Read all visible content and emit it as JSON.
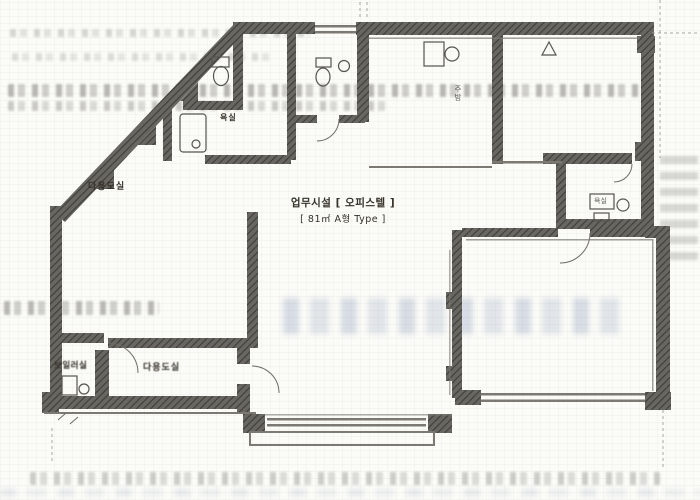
{
  "document_type": "scanned-floor-plan",
  "plan": {
    "title": "업무시설 [ 오피스텔 ]",
    "subtitle": "[ 81㎡ A형 Type ]",
    "rooms": {
      "utility_upper": "다용도실",
      "bath_upper": "욕실",
      "kitchen": "주방",
      "boiler_room": "보일러실",
      "utility_lower": "다용도실",
      "bath_right": "욕실"
    }
  },
  "colors": {
    "paper": "#fbfbf7",
    "wall_base": "#686661",
    "wall_hatch": "#3e3c37",
    "thin_line": "#7b7971",
    "label_ink": "#343129",
    "bleed_gray": "#5c5a54",
    "bleed_blue": "#7a8eb4"
  }
}
